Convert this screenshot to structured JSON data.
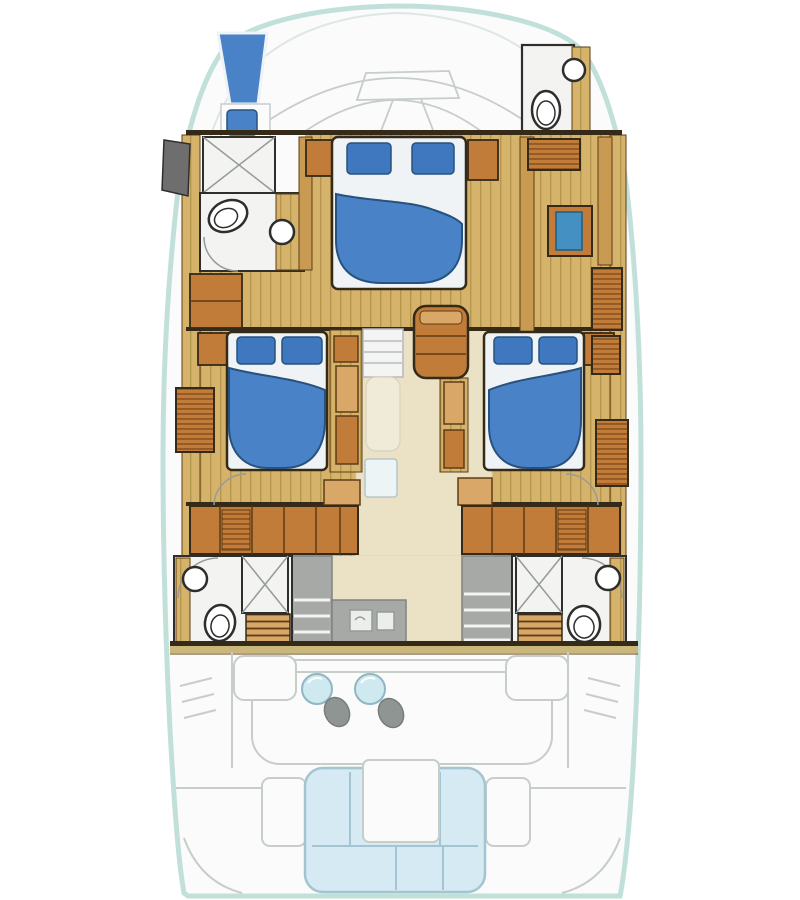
{
  "diagram": {
    "type": "yacht-lower-deck-floor-plan",
    "areas": [
      "bow-deck",
      "bow-seat",
      "forward-head",
      "forward-cabin",
      "forward-bathroom",
      "port-guest-cabin",
      "starboard-guest-cabin",
      "companionway-corridor",
      "galley",
      "port-aft-bathroom",
      "starboard-aft-bathroom",
      "cockpit",
      "cockpit-tables",
      "stern-sofa"
    ],
    "fixtures": [
      "double-bed",
      "pillows",
      "toilet",
      "sink",
      "shower",
      "bench",
      "stairs",
      "wardrobe",
      "desk",
      "round-table",
      "stool",
      "u-sofa",
      "sofa-table"
    ]
  },
  "icons": {
    "toilet": "oval-fixture",
    "sink": "circle-fixture",
    "shower": "x-tile-square",
    "bed": "rounded-duvet",
    "table": "circle",
    "stool": "ellipse",
    "sofa": "u-shape"
  },
  "colors": {
    "background": "#ffffff",
    "hull_outline": "#c2e0da",
    "deck_fill": "#fafbfa",
    "deck_line": "#c7cdc9",
    "deck_line_soft": "#dfe7e3",
    "wall_dark": "#352a18",
    "wood_floor": "#d6b36b",
    "wood_floor_line": "#b6954f",
    "wood_mid": "#c89a52",
    "wood_cabinet": "#c27c3a",
    "wood_cabinet_light": "#d9a868",
    "wood_dark_line": "#5d3c16",
    "louver_stripe": "#8f5420",
    "bulkhead_band": "#c9b77c",
    "bed_blue": "#4a82c8",
    "pillow_blue": "#3f78bf",
    "pillow_stroke": "#27527e",
    "bed_white": "#eff3f6",
    "bath_floor": "#f3f4f2",
    "bath_line": "#949b98",
    "fixture": "#2e2e2c",
    "locker_grey": "#6e6e6e",
    "corridor_floor": "#ebe2c6",
    "corridor_edge": "#d9d2bc",
    "ramp_fill": "#f0ead9",
    "ramp_edge": "#d8d1bb",
    "panel_fill": "#edf4f6",
    "panel_edge": "#b7c5cb",
    "counter_grey": "#a6a9a6",
    "counter_edge": "#7e8380",
    "appliance_white": "#eceeec",
    "step_white": "#f3f4f3",
    "step_edge": "#b5bab6",
    "step_line": "#c6cbc7",
    "table_blue": "#cfe9f1",
    "table_stroke": "#8fb6c2",
    "stool_grey": "#8e9593",
    "stool_stroke": "#777d7a",
    "sofa_blue": "#d5eaf2",
    "sofa_line": "#a3c4d0",
    "accent_blue": "#4590c2",
    "accent_blue_stroke": "#1c5e80",
    "white": "#ffffff"
  }
}
